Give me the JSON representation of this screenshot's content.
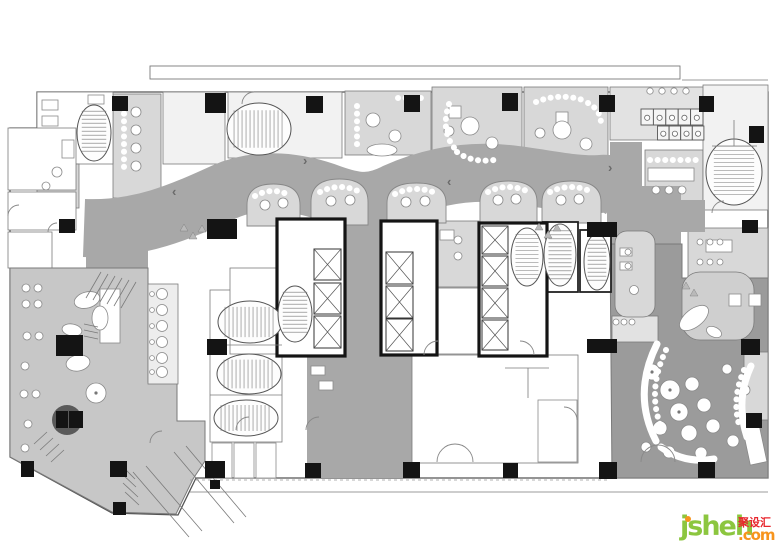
{
  "watermark": {
    "brand": "jsheh",
    "cjk": "聚设汇",
    "suffix": ".com",
    "color_brand": "#8cc63f",
    "color_cjk": "#e8262d",
    "color_accent": "#f7941d"
  },
  "palette": {
    "wall": "#141414",
    "line": "#7a7a7a",
    "outline": "#555555",
    "corridor": "#a8a8a8",
    "restaurant": "#9b9b9b",
    "lounge": "#c7c7c7",
    "light": "#d8d8d8",
    "light2": "#e2e2e2",
    "mid": "#cfcfcf",
    "faint": "#f2f2f2",
    "strip": "#ededed",
    "white": "#ffffff"
  },
  "plan": {
    "outline": "M37,92 H768 V478 H196 L178,515 L112,513 L10,457 V128 H37 Z",
    "roofline": {
      "x": 150,
      "y": 66,
      "w": 530,
      "h": 13
    },
    "corridor": {
      "spine": "M84,228 C140,230 180,212 224,192 C260,176 300,182 332,194 C358,203 372,204 396,192 C432,176 470,170 508,174 C544,178 576,186 600,184 C610,183 616,186 622,190",
      "width": 58,
      "fills": [
        "M345,178 h37 v177 h-37 Z",
        "M307,353 h106 v125 h-106 Z",
        "M607,186 h74 v104 h-74 Z",
        "M610,142 h32 v92 h-32 Z",
        "M607,200 h98 v32 h-98 Z",
        "M86,208 h62 v64 h-62 Z"
      ]
    },
    "lounge": "M10,268 H148 V382 H177 V421 H205 V461 L193,479 L176,514 L112,512 L10,457 Z",
    "restaurant": "M610,244 H682 V278 H768 V478 H612 Z",
    "rooms": [
      {
        "x": 113,
        "y": 94,
        "w": 48,
        "h": 104,
        "f": "light"
      },
      {
        "x": 163,
        "y": 92,
        "w": 62,
        "h": 72,
        "f": "faint"
      },
      {
        "x": 228,
        "y": 92,
        "w": 114,
        "h": 66,
        "f": "faint"
      },
      {
        "x": 345,
        "y": 91,
        "w": 86,
        "h": 64,
        "f": "light"
      },
      {
        "x": 432,
        "y": 87,
        "w": 90,
        "h": 72,
        "f": "light"
      },
      {
        "x": 524,
        "y": 87,
        "w": 84,
        "h": 72,
        "f": "light"
      },
      {
        "x": 610,
        "y": 87,
        "w": 94,
        "h": 53,
        "f": "light2"
      },
      {
        "x": 645,
        "y": 150,
        "w": 58,
        "h": 55,
        "f": "light"
      },
      {
        "x": 703,
        "y": 85,
        "w": 65,
        "h": 125,
        "f": "faint"
      },
      {
        "x": 688,
        "y": 228,
        "w": 80,
        "h": 50,
        "f": "light"
      },
      {
        "x": 437,
        "y": 221,
        "w": 42,
        "h": 66,
        "f": "light"
      },
      {
        "x": 37,
        "y": 92,
        "w": 76,
        "h": 72,
        "f": "white"
      },
      {
        "x": 37,
        "y": 164,
        "w": 42,
        "h": 44,
        "f": "light"
      },
      {
        "x": 8,
        "y": 128,
        "w": 68,
        "h": 62,
        "f": "white"
      },
      {
        "x": 8,
        "y": 192,
        "w": 68,
        "h": 38,
        "f": "white"
      },
      {
        "x": 8,
        "y": 232,
        "w": 44,
        "h": 36,
        "f": "white"
      },
      {
        "x": 210,
        "y": 290,
        "w": 72,
        "h": 152,
        "f": "white"
      },
      {
        "x": 230,
        "y": 268,
        "w": 78,
        "h": 86,
        "f": "white"
      },
      {
        "x": 435,
        "y": 288,
        "w": 44,
        "h": 66,
        "f": "white"
      },
      {
        "x": 412,
        "y": 355,
        "w": 166,
        "h": 108,
        "f": "white",
        "layer": 2
      },
      {
        "x": 682,
        "y": 272,
        "w": 72,
        "h": 68,
        "f": "mid",
        "rx": 18,
        "layer": 2
      },
      {
        "x": 744,
        "y": 352,
        "w": 24,
        "h": 68,
        "f": "light",
        "layer": 2
      },
      {
        "x": 612,
        "y": 316,
        "w": 46,
        "h": 26,
        "f": "light2",
        "layer": 2
      },
      {
        "x": 615,
        "y": 231,
        "w": 40,
        "h": 86,
        "f": "light",
        "rx": 12,
        "layer": 2
      },
      {
        "x": 148,
        "y": 284,
        "w": 30,
        "h": 100,
        "f": "strip",
        "layer": 2
      }
    ],
    "booths": [
      [
        247,
        184,
        53,
        42
      ],
      [
        311,
        179,
        57,
        46
      ],
      [
        387,
        183,
        59,
        40
      ],
      [
        480,
        181,
        57,
        42
      ],
      [
        542,
        181,
        59,
        42
      ]
    ],
    "heavyRects": [
      [
        543,
        222,
        35,
        70
      ],
      [
        580,
        230,
        31,
        62
      ]
    ],
    "banks": [
      [
        277,
        219,
        68,
        137
      ],
      [
        381,
        221,
        56,
        134
      ],
      [
        479,
        223,
        68,
        133
      ]
    ],
    "shafts": [
      [
        314,
        249,
        27,
        31
      ],
      [
        314,
        283,
        27,
        31
      ],
      [
        314,
        316,
        27,
        32
      ],
      [
        386,
        252,
        27,
        32
      ],
      [
        386,
        286,
        27,
        32
      ],
      [
        386,
        319,
        27,
        32
      ],
      [
        482,
        226,
        26,
        28
      ],
      [
        482,
        256,
        26,
        30
      ],
      [
        482,
        288,
        26,
        30
      ],
      [
        482,
        320,
        26,
        30
      ]
    ],
    "ovalStairs": [
      [
        259,
        129,
        32,
        26,
        "h"
      ],
      [
        734,
        172,
        28,
        33,
        "v"
      ],
      [
        94,
        133,
        17,
        28,
        "v"
      ],
      [
        250,
        322,
        32,
        21,
        "h"
      ],
      [
        249,
        374,
        32,
        20,
        "h"
      ],
      [
        246,
        418,
        32,
        18,
        "h"
      ],
      [
        560,
        255,
        16,
        31,
        "v"
      ],
      [
        597,
        262,
        13,
        28,
        "v"
      ],
      [
        295,
        314,
        17,
        28,
        "v"
      ],
      [
        527,
        257,
        16,
        29,
        "v"
      ]
    ],
    "columns": [
      [
        112,
        96,
        16,
        15
      ],
      [
        205,
        93,
        21,
        20
      ],
      [
        306,
        96,
        17,
        17
      ],
      [
        404,
        95,
        16,
        17
      ],
      [
        502,
        93,
        16,
        18
      ],
      [
        599,
        95,
        16,
        17
      ],
      [
        699,
        96,
        15,
        16
      ],
      [
        749,
        126,
        15,
        17
      ],
      [
        59,
        219,
        16,
        14
      ],
      [
        207,
        219,
        30,
        20
      ],
      [
        587,
        222,
        30,
        15
      ],
      [
        742,
        220,
        16,
        13
      ],
      [
        56,
        335,
        27,
        21
      ],
      [
        207,
        339,
        20,
        16
      ],
      [
        587,
        339,
        30,
        14
      ],
      [
        741,
        339,
        19,
        16
      ],
      [
        746,
        413,
        16,
        15
      ],
      [
        21,
        461,
        13,
        16
      ],
      [
        110,
        461,
        17,
        16
      ],
      [
        205,
        461,
        20,
        17
      ],
      [
        305,
        463,
        16,
        15
      ],
      [
        403,
        462,
        17,
        16
      ],
      [
        503,
        463,
        15,
        15
      ],
      [
        599,
        462,
        18,
        17
      ],
      [
        698,
        462,
        17,
        16
      ],
      [
        113,
        502,
        13,
        13
      ],
      [
        210,
        480,
        10,
        9
      ],
      [
        56,
        411,
        12,
        17
      ],
      [
        69,
        411,
        14,
        17
      ]
    ],
    "darkCircle": {
      "cx": 67,
      "cy": 420,
      "r": 15
    },
    "toiletRows": [
      {
        "x": 641,
        "y": 109,
        "w": 12.4,
        "h": 16,
        "n": 5
      },
      {
        "x": 657.5,
        "y": 126,
        "w": 11.6,
        "h": 14,
        "n": 4
      }
    ],
    "rects": [
      [
        42,
        100,
        16,
        10
      ],
      [
        42,
        116,
        16,
        10
      ],
      [
        62,
        140,
        12,
        18
      ],
      [
        88,
        95,
        16,
        9
      ],
      [
        449,
        106,
        12,
        12
      ],
      [
        556,
        112,
        12,
        12
      ],
      [
        706,
        240,
        26,
        12
      ],
      [
        620,
        248,
        12,
        8
      ],
      [
        620,
        262,
        12,
        8
      ],
      [
        440,
        230,
        14,
        10
      ],
      [
        648,
        168,
        46,
        13
      ],
      [
        100,
        289,
        20,
        54
      ],
      [
        311,
        366,
        14,
        9
      ],
      [
        319,
        381,
        14,
        9
      ],
      [
        538,
        400,
        39,
        62
      ],
      [
        729,
        294,
        12,
        12
      ],
      [
        749,
        294,
        12,
        12
      ],
      [
        212,
        443,
        20,
        35
      ],
      [
        234,
        443,
        20,
        35
      ],
      [
        256,
        443,
        20,
        35
      ]
    ],
    "rotRects": [
      [
        742,
        426,
        17,
        40,
        -12
      ]
    ],
    "ellipses": [
      [
        87,
        300,
        13,
        8,
        -15
      ],
      [
        100,
        318,
        8,
        12,
        0
      ],
      [
        72,
        330,
        10,
        6,
        10
      ],
      [
        78,
        363,
        12,
        8,
        -10
      ],
      [
        694,
        318,
        17,
        9,
        -38
      ],
      [
        714,
        332,
        8,
        5,
        25
      ],
      [
        382,
        150,
        15,
        6,
        0
      ]
    ],
    "circles": [
      [
        162,
        294,
        5.5
      ],
      [
        162,
        310,
        5.5
      ],
      [
        162,
        326,
        5.5
      ],
      [
        162,
        342,
        5.5
      ],
      [
        162,
        358,
        5.5
      ],
      [
        162,
        372,
        5.5
      ],
      [
        152,
        294,
        2.4
      ],
      [
        152,
        310,
        2.4
      ],
      [
        152,
        326,
        2.4
      ],
      [
        152,
        342,
        2.4
      ],
      [
        152,
        358,
        2.4
      ],
      [
        152,
        372,
        2.4
      ],
      [
        26,
        288,
        4
      ],
      [
        38,
        288,
        4
      ],
      [
        26,
        304,
        4
      ],
      [
        38,
        304,
        4
      ],
      [
        27,
        336,
        4
      ],
      [
        39,
        336,
        4
      ],
      [
        25,
        366,
        4
      ],
      [
        24,
        394,
        4
      ],
      [
        36,
        394,
        4
      ],
      [
        28,
        424,
        4
      ],
      [
        25,
        448,
        4
      ],
      [
        96,
        393,
        10
      ],
      [
        373,
        120,
        7
      ],
      [
        395,
        136,
        6
      ],
      [
        412,
        104,
        5
      ],
      [
        470,
        126,
        9
      ],
      [
        492,
        143,
        6
      ],
      [
        449,
        131,
        5
      ],
      [
        562,
        130,
        9
      ],
      [
        586,
        144,
        6
      ],
      [
        540,
        133,
        5
      ],
      [
        136,
        112,
        5
      ],
      [
        136,
        130,
        5
      ],
      [
        136,
        148,
        5
      ],
      [
        136,
        166,
        5
      ],
      [
        656,
        190,
        4
      ],
      [
        669,
        190,
        4
      ],
      [
        682,
        190,
        4
      ],
      [
        650,
        91,
        3.2
      ],
      [
        662,
        91,
        3.2
      ],
      [
        674,
        91,
        3.2
      ],
      [
        686,
        91,
        3.2
      ],
      [
        700,
        242,
        3
      ],
      [
        710,
        242,
        3
      ],
      [
        720,
        242,
        3
      ],
      [
        700,
        262,
        3
      ],
      [
        710,
        262,
        3
      ],
      [
        720,
        262,
        3
      ],
      [
        634,
        290,
        4.5
      ],
      [
        628,
        252,
        3
      ],
      [
        628,
        266,
        3
      ],
      [
        458,
        240,
        4
      ],
      [
        458,
        256,
        4
      ],
      [
        265,
        205,
        5
      ],
      [
        283,
        203,
        5
      ],
      [
        331,
        201,
        5
      ],
      [
        350,
        200,
        5
      ],
      [
        406,
        202,
        5
      ],
      [
        425,
        201,
        5
      ],
      [
        498,
        200,
        5
      ],
      [
        516,
        199,
        5
      ],
      [
        561,
        200,
        5
      ],
      [
        579,
        199,
        5
      ],
      [
        652,
        372,
        8
      ],
      [
        670,
        390,
        10
      ],
      [
        692,
        384,
        7
      ],
      [
        679,
        412,
        9
      ],
      [
        704,
        405,
        7
      ],
      [
        660,
        428,
        7
      ],
      [
        689,
        433,
        8
      ],
      [
        713,
        426,
        7
      ],
      [
        733,
        441,
        6
      ],
      [
        701,
        453,
        6
      ],
      [
        669,
        452,
        6
      ],
      [
        646,
        447,
        5
      ],
      [
        727,
        369,
        5
      ],
      [
        745,
        390,
        5
      ],
      [
        616,
        322,
        3
      ],
      [
        624,
        322,
        3
      ],
      [
        632,
        322,
        3
      ],
      [
        57,
        172,
        5
      ],
      [
        46,
        186,
        4
      ],
      [
        98,
        130,
        5
      ]
    ],
    "dotsGray": [
      [
        96,
        393,
        1.6
      ],
      [
        670,
        390,
        1.6
      ],
      [
        679,
        412,
        1.6
      ],
      [
        652,
        372,
        1.6
      ]
    ],
    "whiteArcs": [
      "M657,344 Q632,394 656,441",
      "M661,447 Q684,464 714,459",
      "M751,366 Q735,400 747,437"
    ],
    "dotArcs": [
      "M666,350 Q645,394 664,434",
      "M744,370 Q731,400 740,428",
      "M449,104 Q440,132 456,150",
      "M457,152 Q472,163 494,160",
      "M536,102 Q560,92 586,101",
      "M588,103 Q601,110 601,124",
      "M255,196 Q273,186 291,196",
      "M320,192 Q340,182 360,192",
      "M395,194 Q416,184 438,194",
      "M488,192 Q508,182 529,192",
      "M550,192 Q571,182 592,192",
      "M357,106 L357,148",
      "M398,98 L425,98",
      "M124,106 L124,168",
      "M650,160 L697,160"
    ],
    "doorArcs": [
      "M437,462 A18 18 0 0 1 455,444",
      "M473,462 A18 18 0 0 0 455,444",
      "M641,462 A17 17 0 0 1 658,445",
      "M675,462 A17 17 0 0 0 658,445",
      "M424,355 A14 14 0 0 1 438,341",
      "M534,355 A14 14 0 0 0 520,341",
      "M236,430 A13 13 0 0 1 249,417",
      "M8,216 A11 11 0 0 1 19,205",
      "M48,232 A9 9 0 0 1 57,223",
      "M150,443 A12 12 0 0 1 162,431",
      "M254,92 A12 12 0 0 0 242,104",
      "M712,213 A12 12 0 0 1 724,201",
      "M306,430 A13 13 0 0 1 319,417",
      "M577,420 A13 13 0 0 0 564,407"
    ],
    "segs": [
      [
        86,
        298,
        101,
        272
      ],
      [
        93,
        300,
        108,
        274
      ],
      [
        100,
        302,
        115,
        276
      ],
      [
        107,
        304,
        122,
        278
      ],
      [
        114,
        306,
        129,
        280
      ],
      [
        121,
        308,
        136,
        282
      ],
      [
        84,
        324,
        98,
        327
      ],
      [
        84,
        330,
        98,
        333
      ],
      [
        84,
        336,
        98,
        339
      ],
      [
        34,
        444,
        47,
        432
      ],
      [
        40,
        450,
        53,
        438
      ],
      [
        46,
        456,
        59,
        444
      ],
      [
        51,
        462,
        64,
        450
      ],
      [
        133,
        472,
        189,
        537
      ],
      [
        146,
        466,
        202,
        531
      ],
      [
        174,
        452,
        234,
        523
      ],
      [
        186,
        446,
        246,
        517
      ],
      [
        119,
        463,
        135,
        479
      ],
      [
        121,
        473,
        136,
        487
      ],
      [
        123,
        483,
        138,
        497
      ],
      [
        125,
        492,
        139,
        505
      ],
      [
        505,
        368,
        549,
        368
      ],
      [
        528,
        368,
        528,
        398
      ],
      [
        712,
        146,
        757,
        146
      ],
      [
        734,
        120,
        734,
        146
      ],
      [
        682,
        80,
        768,
        80
      ],
      [
        190,
        492,
        768,
        492
      ],
      [
        210,
        345,
        282,
        345
      ],
      [
        210,
        395,
        282,
        395
      ]
    ],
    "dashedSegs": [
      [
        190,
        480,
        610,
        480
      ]
    ],
    "triangles": [
      [
        184,
        228
      ],
      [
        193,
        236
      ],
      [
        202,
        229
      ],
      [
        539,
        227
      ],
      [
        548,
        235
      ],
      [
        557,
        228
      ],
      [
        686,
        286
      ],
      [
        694,
        293
      ]
    ],
    "chevrons": [
      [
        172,
        196,
        "‹"
      ],
      [
        303,
        165,
        "›"
      ],
      [
        608,
        172,
        "›"
      ],
      [
        447,
        186,
        "‹"
      ]
    ]
  }
}
